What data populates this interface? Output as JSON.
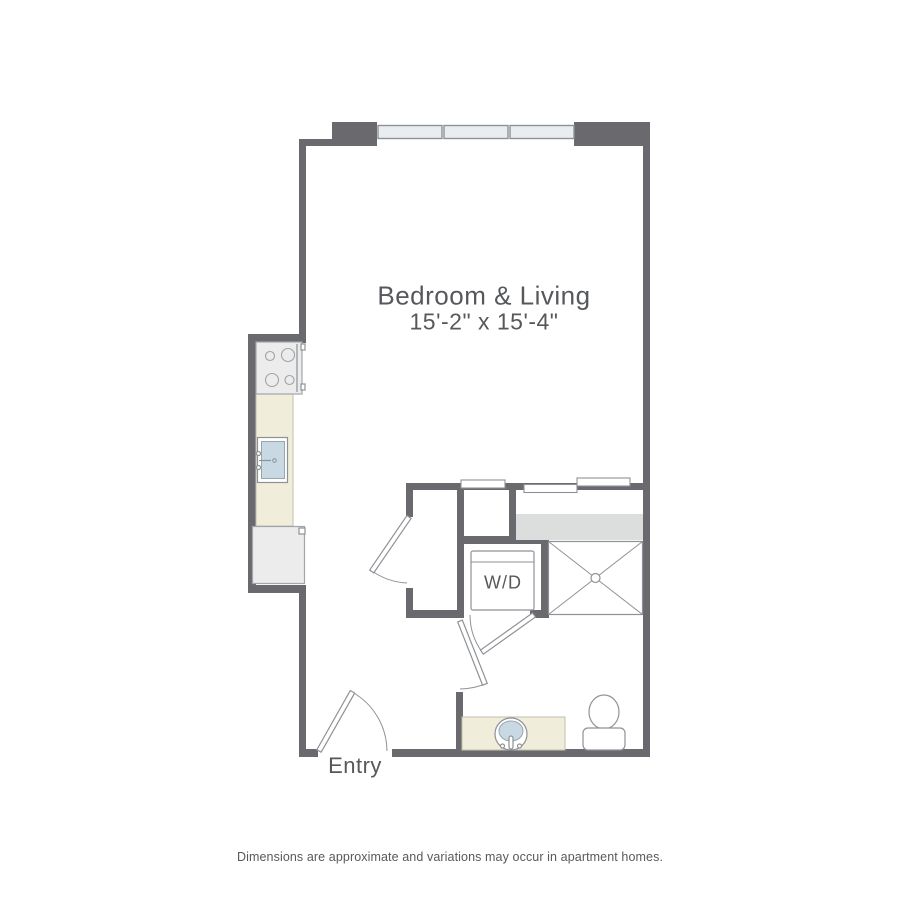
{
  "floor_plan": {
    "room_label": "Bedroom & Living",
    "room_dimensions": "15'-2\" x 15'-4\"",
    "washer_dryer_label": "W/D",
    "entry_label": "Entry"
  },
  "footer": {
    "disclaimer": "Dimensions are approximate and variations may occur in apartment homes."
  },
  "colors": {
    "wall": "#6a6a6e",
    "line": "#8e9296",
    "window_fill": "#e8edf0",
    "shelf_fill": "#dcdddd",
    "counter_fill": "#f0edda",
    "basin_fill": "#c9d9e3",
    "appliance_fill": "#ececec",
    "label_text": "#56585b",
    "disclaimer_text": "#58595b"
  }
}
